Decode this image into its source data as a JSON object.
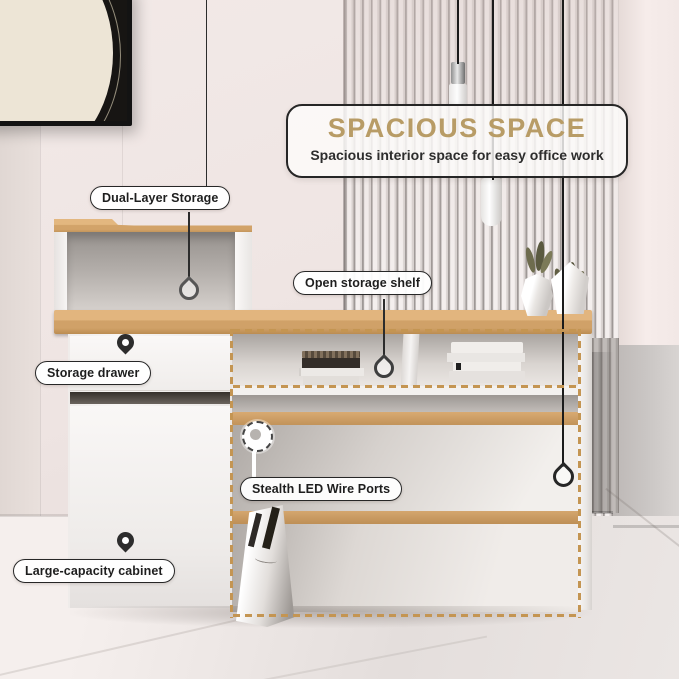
{
  "banner": {
    "title": "SPACIOUS SPACE",
    "subtitle": "Spacious interior space for easy office work"
  },
  "callouts": [
    {
      "id": "dual-layer-storage",
      "text": "Dual-Layer Storage"
    },
    {
      "id": "open-storage-shelf",
      "text": "Open storage shelf"
    },
    {
      "id": "storage-drawer",
      "text": "Storage drawer"
    },
    {
      "id": "stealth-led-wire-ports",
      "text": "Stealth LED Wire Ports"
    },
    {
      "id": "large-capacity-cabinet",
      "text": "Large-capacity cabinet"
    }
  ],
  "icons": {
    "map_pin": "filled-teardrop-location-pin",
    "drop_pin": "hollow-teardrop-hanging-pin",
    "wire_port": "dashed-circle-with-dot"
  },
  "colors": {
    "accent_gold": "#B89C66",
    "dash_outline": "#C49552",
    "label_border": "#272727",
    "wood_top": "#E0B27C",
    "wood_edge": "#C2935A",
    "desk_white": "#F6F4F3",
    "wall_pink": "#EFE5E3",
    "slat_light": "#F4EFEE",
    "plant_olive": "#5B5A40"
  }
}
